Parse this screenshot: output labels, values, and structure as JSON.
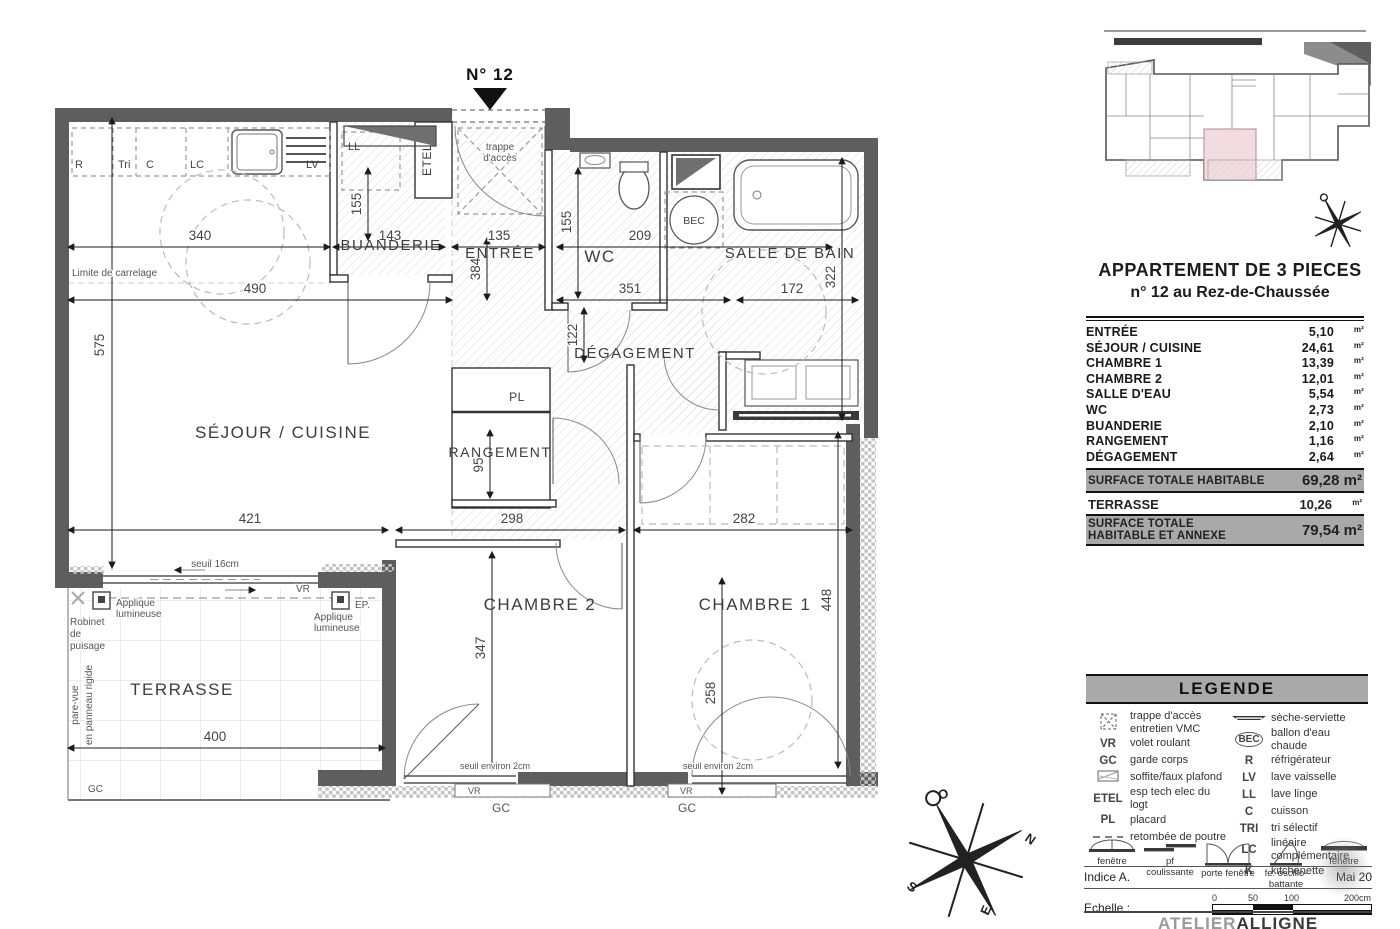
{
  "plan": {
    "marker_no": "N° 12",
    "rooms": {
      "sejour": "SÉJOUR / CUISINE",
      "buanderie": "BUANDERIE",
      "entree": "ENTRÉE",
      "wc": "WC",
      "sdb": "SALLE DE BAIN",
      "degagement": "DÉGAGEMENT",
      "rangement": "RANGEMENT",
      "chambre2": "CHAMBRE 2",
      "chambre1": "CHAMBRE 1",
      "terrasse": "TERRASSE",
      "pl": "PL",
      "ll": "LL",
      "etel": "ETEL",
      "bec": "BEC"
    },
    "kitchen": {
      "r": "R",
      "tri": "Tri",
      "c": "C",
      "lc": "LC",
      "lv": "LV"
    },
    "dims": {
      "d340": "340",
      "d490": "490",
      "d575": "575",
      "d155b": "155",
      "d143": "143",
      "d135": "135",
      "d384": "384",
      "d155w": "155",
      "d209": "209",
      "d351": "351",
      "d172": "172",
      "d322": "322",
      "d122": "122",
      "d421": "421",
      "d298": "298",
      "d282": "282",
      "d347": "347",
      "d448": "448",
      "d400": "400",
      "d258": "258",
      "d95": "95"
    },
    "annotations": {
      "limite": "Limite de carrelage",
      "trappe_l1": "trappe",
      "trappe_l2": "d'accès",
      "seuil16": "seuil 16cm",
      "vr": "VR",
      "gc": "GC",
      "ep": "EP.",
      "applique_l1": "Applique",
      "applique_l2": "lumineuse",
      "robinet_l1": "Robinet",
      "robinet_l2": "de",
      "robinet_l3": "puisage",
      "parevue_l1": "pare-vue",
      "parevue_l2": "en panneau rigide",
      "seuil2": "seuil environ 2cm"
    },
    "compass": {
      "n": "N",
      "s": "S",
      "e": "E",
      "o": "O"
    }
  },
  "panel": {
    "title_line1": "APPARTEMENT DE 3 PIECES",
    "title_line2": "n° 12 au Rez-de-Chaussée",
    "areas": [
      {
        "label": "ENTRÉE",
        "value": "5,10",
        "unit": "m²"
      },
      {
        "label": "SÉJOUR / CUISINE",
        "value": "24,61",
        "unit": "m²"
      },
      {
        "label": "CHAMBRE 1",
        "value": "13,39",
        "unit": "m²"
      },
      {
        "label": "CHAMBRE 2",
        "value": "12,01",
        "unit": "m²"
      },
      {
        "label": "SALLE D'EAU",
        "value": "5,54",
        "unit": "m²"
      },
      {
        "label": "WC",
        "value": "2,73",
        "unit": "m²"
      },
      {
        "label": "BUANDERIE",
        "value": "2,10",
        "unit": "m²"
      },
      {
        "label": "RANGEMENT",
        "value": "1,16",
        "unit": "m²"
      },
      {
        "label": "DÉGAGEMENT",
        "value": "2,64",
        "unit": "m²"
      }
    ],
    "total_habitable": {
      "label": "SURFACE TOTALE HABITABLE",
      "value": "69,28 m²"
    },
    "terrasse_row": {
      "label": "TERRASSE",
      "value": "10,26",
      "unit": "m²"
    },
    "total_annexe": {
      "label": "SURFACE TOTALE HABITABLE ET ANNEXE",
      "value": "79,54 m²"
    },
    "legend": {
      "header": "LEGENDE",
      "left": [
        {
          "sym": "",
          "l1": "trappe d'accès",
          "l2": "entretien VMC"
        },
        {
          "sym": "VR",
          "l1": "volet roulant",
          "l2": ""
        },
        {
          "sym": "GC",
          "l1": "garde corps",
          "l2": ""
        },
        {
          "sym": "",
          "l1": "soffite/faux plafond",
          "l2": ""
        },
        {
          "sym": "ETEL",
          "l1": "esp tech elec  du logt",
          "l2": ""
        },
        {
          "sym": "PL",
          "l1": "placard",
          "l2": ""
        },
        {
          "sym": "",
          "l1": "retombée de poutre",
          "l2": ""
        }
      ],
      "right": [
        {
          "sym": "",
          "l1": "sèche-serviette",
          "l2": ""
        },
        {
          "sym": "BEC",
          "l1": "ballon d'eau chaude",
          "l2": ""
        },
        {
          "sym": "R",
          "l1": "réfrigérateur",
          "l2": ""
        },
        {
          "sym": "LV",
          "l1": "lave vaisselle",
          "l2": ""
        },
        {
          "sym": "LL",
          "l1": "lave linge",
          "l2": ""
        },
        {
          "sym": "C",
          "l1": "cuisson",
          "l2": ""
        },
        {
          "sym": "TRI",
          "l1": "tri sélectif",
          "l2": ""
        },
        {
          "sym": "LC",
          "l1": "linéaire  complémentaire",
          "l2": ""
        },
        {
          "sym": "K",
          "l1": "kitchenette",
          "l2": ""
        }
      ]
    },
    "windows": [
      "fenêtre",
      "pf coulissante",
      "porte fenêtre",
      "fe. oscillo-battante",
      "fenêtre"
    ],
    "indice": "Indice A.",
    "date": "Mai 20",
    "echelle_label": "Echelle :",
    "scale_ticks": [
      "0",
      "50",
      "100",
      "200cm"
    ],
    "firm_light": "ATELIER",
    "firm_bold": "ALLIGNE"
  }
}
